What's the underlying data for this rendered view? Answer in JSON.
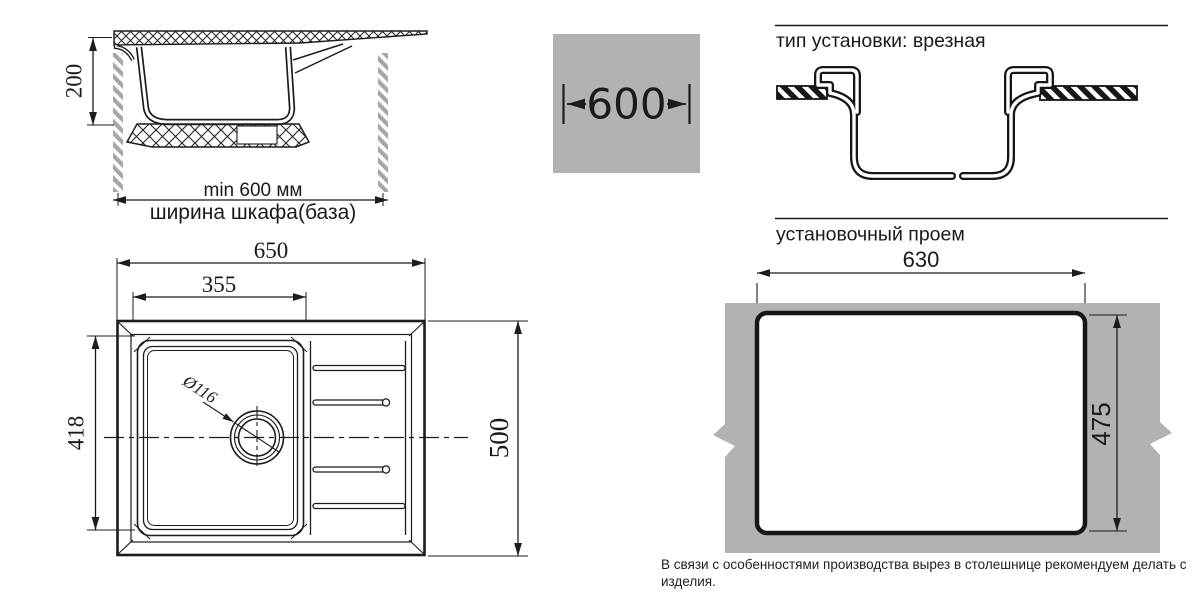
{
  "colors": {
    "panel_gray": "#b2b2b2",
    "line": "#1c1c1c"
  },
  "side_view": {
    "dim_depth": "200",
    "dim_min_width": "min 600 мм",
    "dim_cabinet_width": "ширина шкафа(база)"
  },
  "width_badge": {
    "value": "600"
  },
  "install_type": {
    "title": "тип установки: врезная"
  },
  "cutout": {
    "title": "установочный проем",
    "dim_width": "630",
    "dim_height": "475"
  },
  "top_view": {
    "dim_overall_width": "650",
    "dim_bowl_width": "355",
    "dim_bowl_depth": "418",
    "dim_overall_depth": "500",
    "drain_diameter": "Ø116"
  },
  "footer": {
    "note": "В связи с особенностями производства вырез в столешнице рекомендуем делать с изделия."
  }
}
